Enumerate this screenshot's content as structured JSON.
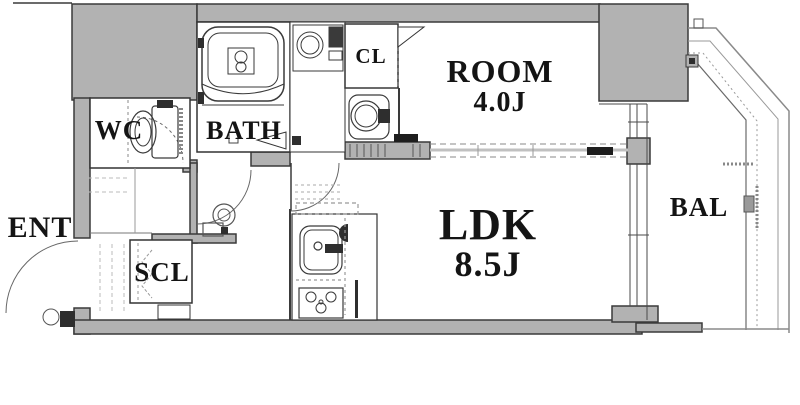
{
  "labels": {
    "ent": "ENT",
    "wc": "WC",
    "bath": "BATH",
    "cl": "CL",
    "room": "ROOM",
    "room_size": "4.0J",
    "ldk": "LDK",
    "ldk_size": "8.5J",
    "scl": "SCL",
    "bal": "BAL"
  },
  "colors": {
    "wall_fill": "#b2b2b2",
    "wall_edge": "#3a3a3a",
    "line": "#555555",
    "light_line": "#9a9a9a",
    "text": "#141414",
    "background": "#ffffff"
  }
}
